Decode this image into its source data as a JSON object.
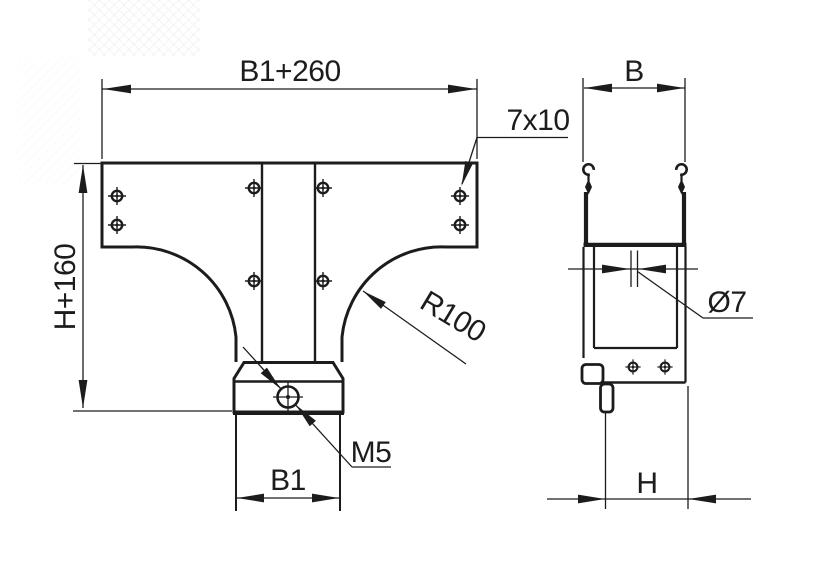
{
  "drawing": {
    "type": "technical-drawing",
    "views": {
      "front": {
        "labels": {
          "width_top": "B1+260",
          "slot": "7x10",
          "height": "H+160",
          "radius": "R100",
          "thread": "M5",
          "width_bottom": "B1"
        }
      },
      "side": {
        "labels": {
          "width": "B",
          "hole_diameter": "Ø7",
          "height": "H"
        }
      }
    },
    "colors": {
      "line": "#1c1c1c",
      "background": "#ffffff",
      "watermark": "#dcdcdc"
    }
  }
}
